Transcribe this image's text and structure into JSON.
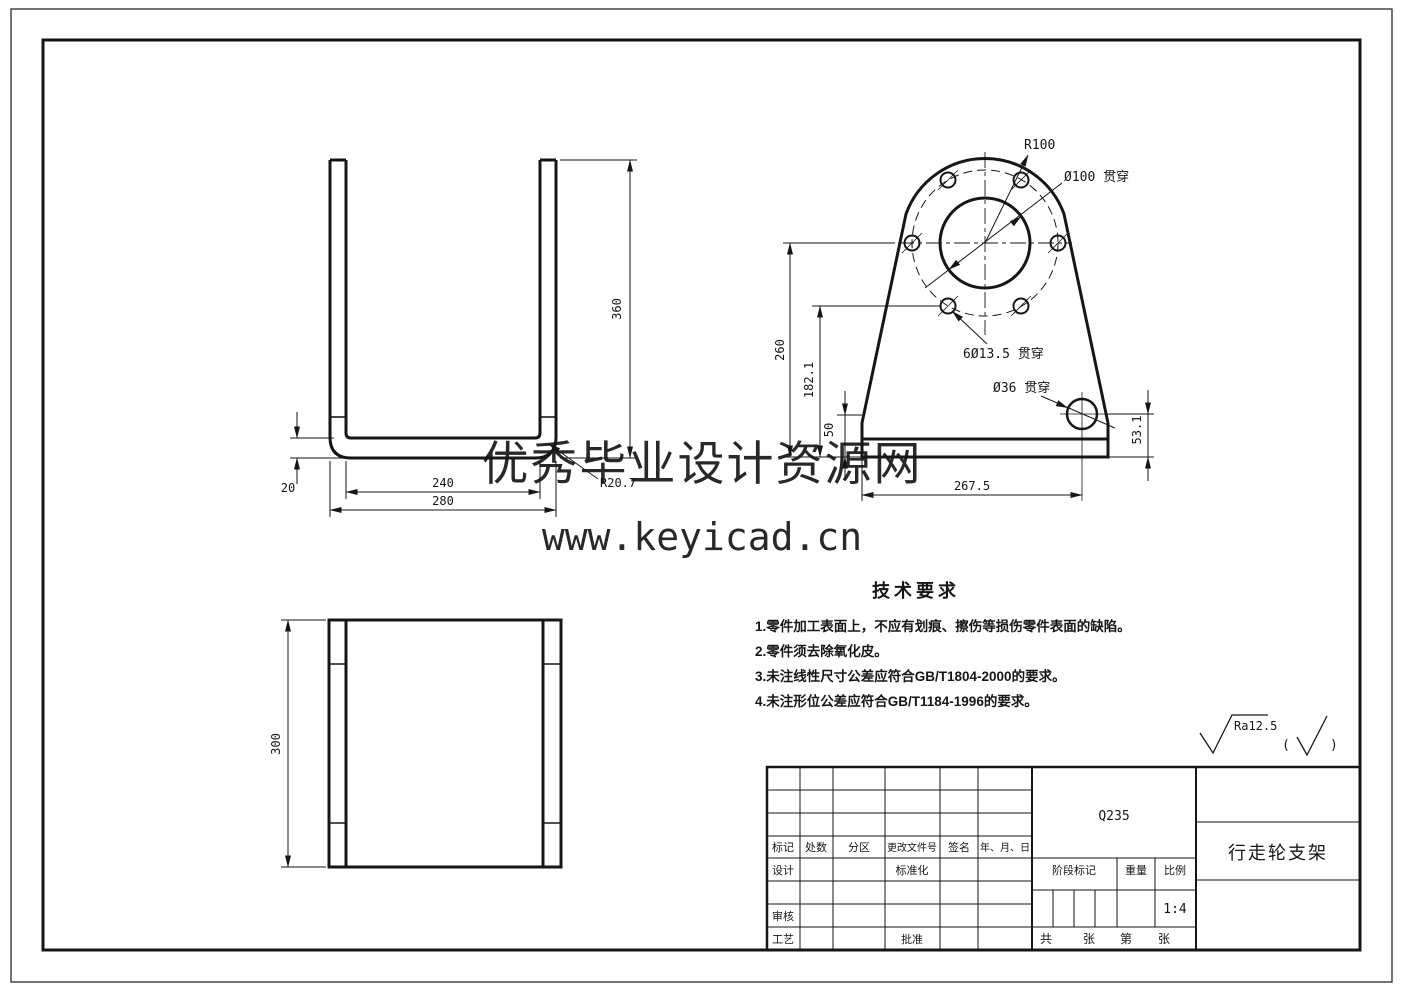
{
  "drawing": {
    "watermark": {
      "line1": "优秀毕业设计资源网",
      "line2": "www.keyicad.cn",
      "color": "#dd1414"
    },
    "views": {
      "front": {
        "dims": {
          "height": "360",
          "thickness": "20",
          "inner_width": "240",
          "outer_width": "280",
          "bend_radius": "R20.7"
        }
      },
      "side": {
        "labels": {
          "top_radius": "R100",
          "center_hole": "Ø100 贯穿",
          "bolt_holes": "6Ø13.5 贯穿",
          "small_hole": "Ø36 贯穿"
        },
        "dims": {
          "center_height": "260",
          "bolt_hole_height": "182.1",
          "corner_height": "50",
          "small_hole_height": "53.1",
          "small_hole_offset": "267.5"
        }
      },
      "top": {
        "dims": {
          "depth": "300"
        }
      }
    },
    "tech_requirements": {
      "title": "技术要求",
      "items": [
        "1.零件加工表面上，不应有划痕、擦伤等损伤零件表面的缺陷。",
        "2.零件须去除氧化皮。",
        "3.未注线性尺寸公差应符合GB/T1804-2000的要求。",
        "4.未注形位公差应符合GB/T1184-1996的要求。"
      ]
    },
    "surface_finish": {
      "value": "Ra12.5",
      "paren_open": "(",
      "paren_close": ")"
    },
    "title_block": {
      "revision_headers": [
        "标记",
        "处数",
        "分区",
        "更改文件号",
        "签名",
        "年、月、日"
      ],
      "roles": {
        "design": "设计",
        "standardization": "标准化",
        "review": "审核",
        "process": "工艺",
        "approve": "批准"
      },
      "material": "Q235",
      "part_name": "行走轮支架",
      "stage_label": "阶段标记",
      "weight_label": "重量",
      "scale_label": "比例",
      "scale_value": "1:4",
      "sheet_labels": [
        "共",
        "张",
        "第",
        "张"
      ]
    }
  }
}
